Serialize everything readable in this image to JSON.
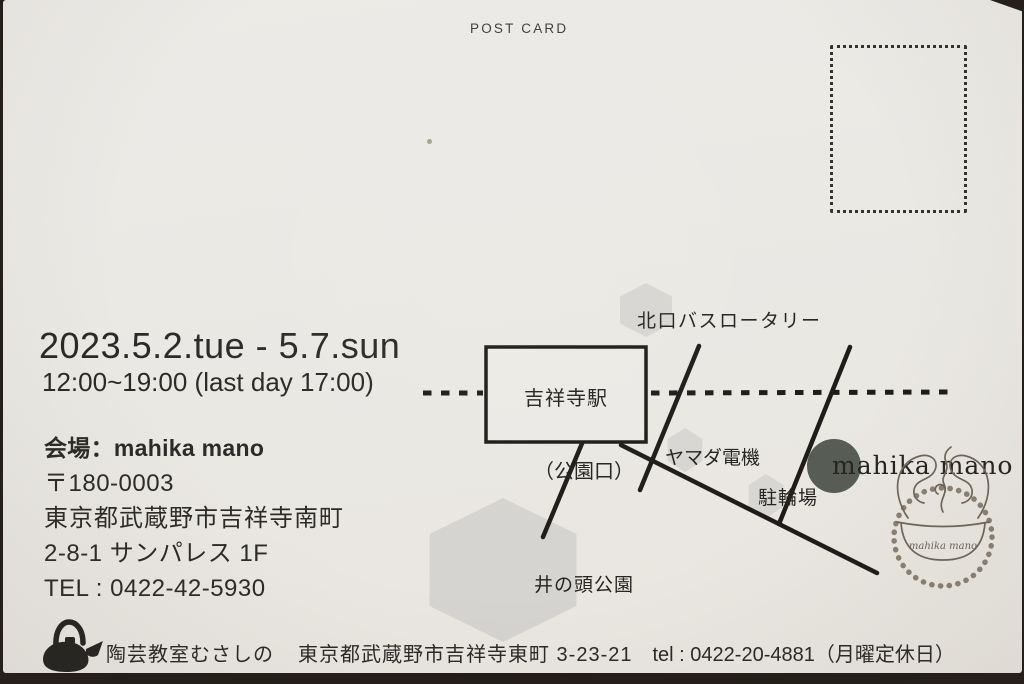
{
  "header": {
    "label": "POST CARD"
  },
  "event": {
    "date_range": "2023.5.2.tue - 5.7.sun",
    "hours": "12:00~19:00 (last day 17:00)"
  },
  "venue": {
    "title": "会場：mahika mano",
    "postal_code": "〒180-0003",
    "address_line1": "東京都武蔵野市吉祥寺南町",
    "address_line2": "2-8-1 サンパレス 1F",
    "tel": "TEL : 0422-42-5930"
  },
  "map": {
    "station_label": "吉祥寺駅",
    "north_exit_label": "北口バスロータリー",
    "park_exit_label": "（公園口）",
    "yamada_label": "ヤマダ電機",
    "bicycle_parking_label": "駐輪場",
    "park_label": "井の頭公園",
    "shop_label": "mahika mano"
  },
  "stamp": {
    "text": "mahika mano"
  },
  "footer": {
    "studio": "陶芸教室むさしの",
    "address": "東京都武蔵野市吉祥寺東町 3-23-21",
    "tel": "tel : 0422-20-4881（月曜定休日）"
  },
  "colors": {
    "ink": "#2d2b29",
    "map_line": "#1d1c1a",
    "hexagon": "#d7d6d2",
    "shop_dot": "#575c54",
    "stamp_ring": "#8b8172",
    "card_background": "#eae8e3",
    "photo_border": "#241e1a"
  }
}
